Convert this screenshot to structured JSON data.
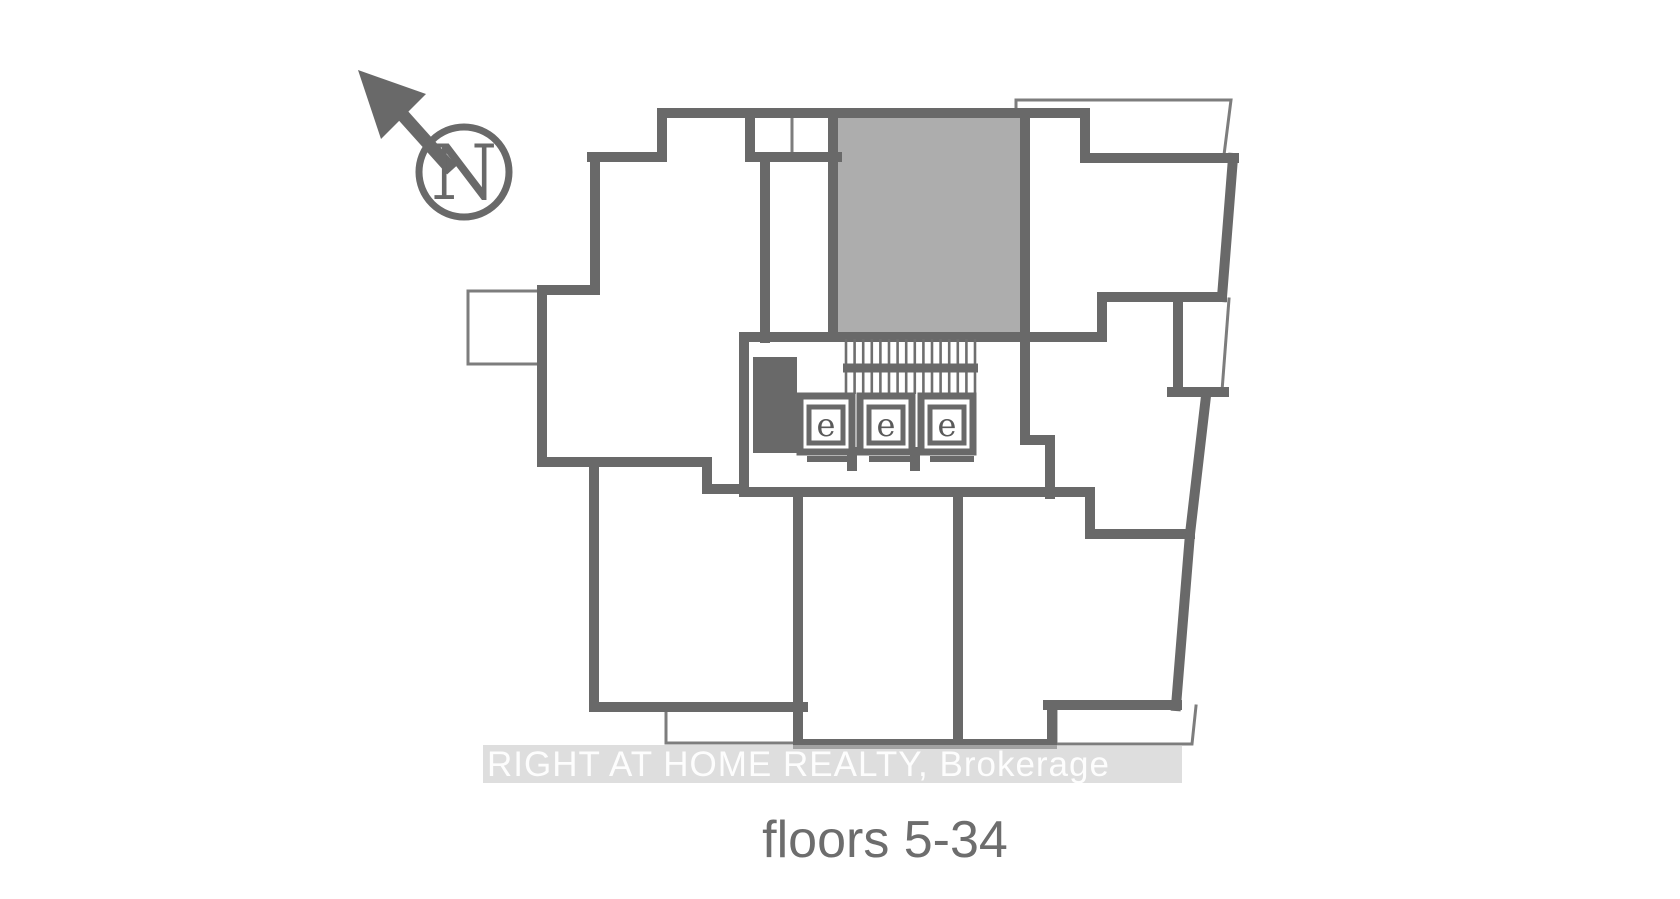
{
  "meta": {
    "type": "condo-keyplate-floor-plan",
    "background_color": "#ffffff"
  },
  "colors": {
    "wall": "#696969",
    "highlighted_unit_fill": "#adadad",
    "thin_outline": "#7d7d7d",
    "watermark_band": "#c8c8c8",
    "watermark_text": "#ffffff",
    "caption_text": "#6d6d6d"
  },
  "north_indicator": {
    "icon": "north-arrow-icon",
    "label": "N"
  },
  "core": {
    "stair": "stair-hatch",
    "elevators": [
      {
        "label": "e"
      },
      {
        "label": "e"
      },
      {
        "label": "e"
      }
    ]
  },
  "highlighted_unit": {
    "position": "top-center",
    "fill": "#adadad"
  },
  "watermark": {
    "text": "RIGHT AT HOME REALTY, Brokerage"
  },
  "caption": {
    "text": "floors 5-34"
  }
}
